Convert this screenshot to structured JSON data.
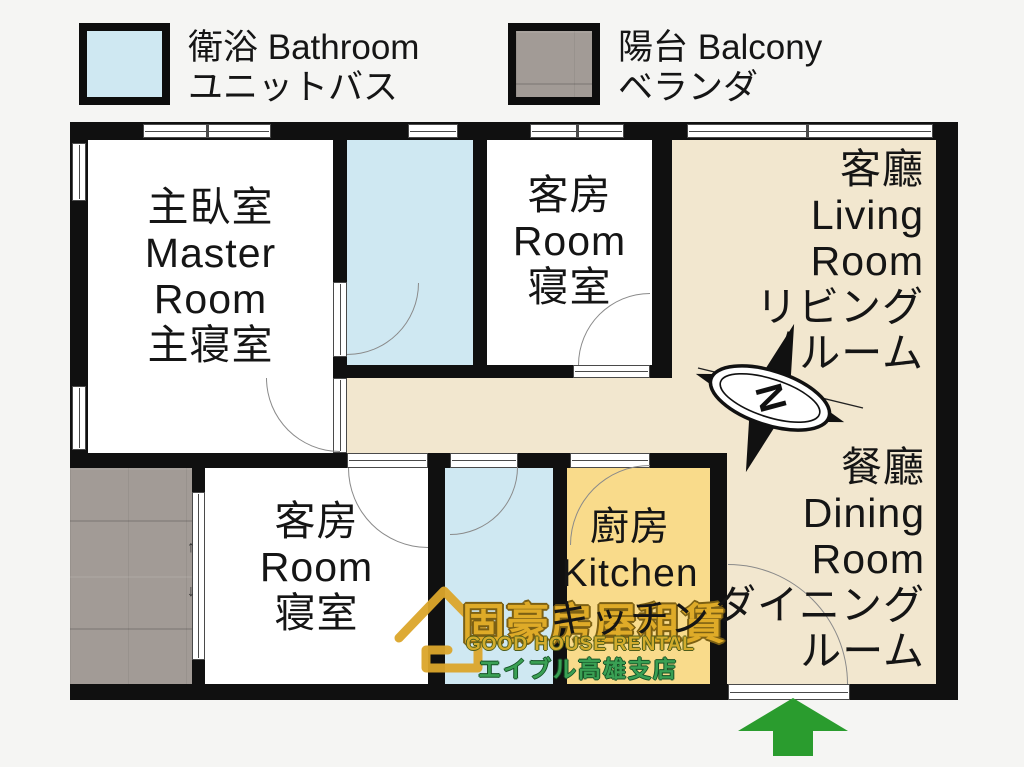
{
  "legend": {
    "bathroom": {
      "label": "衛浴 Bathroom",
      "label_jp": "ユニットバス",
      "swatch_color": "#cfe8f2"
    },
    "balcony": {
      "label": "陽台 Balcony",
      "label_jp": "ベランダ",
      "swatch_color": "#a29b96"
    }
  },
  "rooms": {
    "master_bedroom": {
      "lines": [
        "主臥室",
        "Master",
        "Room",
        "主寝室"
      ]
    },
    "guest_room_top": {
      "lines": [
        "客房",
        "Room",
        "寝室"
      ]
    },
    "living_room": {
      "lines": [
        "客廳",
        "Living",
        "Room",
        "リビング",
        "ルーム"
      ]
    },
    "dining_room": {
      "lines": [
        "餐廳",
        "Dining",
        "Room",
        "ダイニング",
        "ルーム"
      ]
    },
    "guest_room_bottom": {
      "lines": [
        "客房",
        "Room",
        "寝室"
      ]
    },
    "kitchen": {
      "lines": [
        "廚房",
        "Kitchen",
        "キッチン"
      ]
    }
  },
  "compass": {
    "north_label": "N"
  },
  "balcony_slider": {
    "arrow_up": "↑",
    "arrow_down": "↓"
  },
  "watermark": {
    "brand_zh": "固豪房屋租賃",
    "brand_en": "GOOD HOUSE RENTAL",
    "branch_jp": "エイブル高雄支店"
  },
  "colors": {
    "background": "#f5f5f3",
    "wall": "#101010",
    "floor_living_dining": "#f2e7cf",
    "floor_bathroom": "#cfe8f2",
    "floor_kitchen": "#f9db8b",
    "floor_balcony": "#a29b96",
    "entrance_arrow": "#2a9c2e",
    "watermark_gold": "#dfab28",
    "watermark_green": "#3aa054"
  }
}
